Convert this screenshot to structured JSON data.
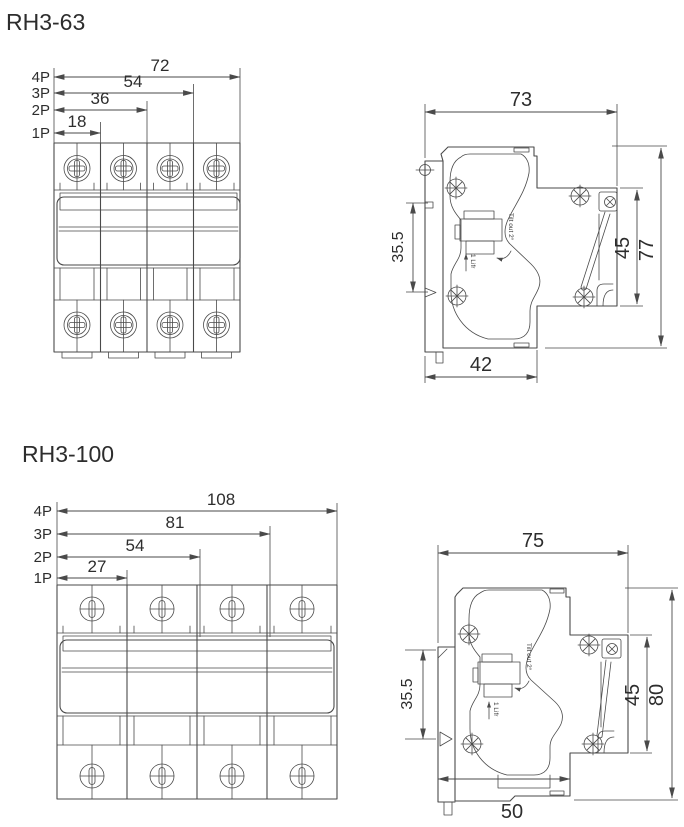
{
  "page": {
    "background": "#ffffff",
    "line_color": "#4a4a4a",
    "text_color": "#2d2d2d"
  },
  "sections": [
    {
      "title": "RH3-63",
      "front": {
        "poles": [
          {
            "label": "4P",
            "width": "72"
          },
          {
            "label": "3P",
            "width": "54"
          },
          {
            "label": "2P",
            "width": "36"
          },
          {
            "label": "1P",
            "width": "18"
          }
        ]
      },
      "side": {
        "width_top": "73",
        "height_front": "35.5",
        "height_din": "45",
        "height_total": "77",
        "width_bottom": "42",
        "note_tilt": "Tilt out 2°",
        "note_lift": "1 Lifr"
      }
    },
    {
      "title": "RH3-100",
      "front": {
        "poles": [
          {
            "label": "4P",
            "width": "108"
          },
          {
            "label": "3P",
            "width": "81"
          },
          {
            "label": "2P",
            "width": "54"
          },
          {
            "label": "1P",
            "width": "27"
          }
        ]
      },
      "side": {
        "width_top": "75",
        "height_front": "35.5",
        "height_din": "45",
        "height_total": "80",
        "width_bottom": "50",
        "note_tilt": "Tilt out 2°",
        "note_lift": "1 Lifr"
      }
    }
  ]
}
